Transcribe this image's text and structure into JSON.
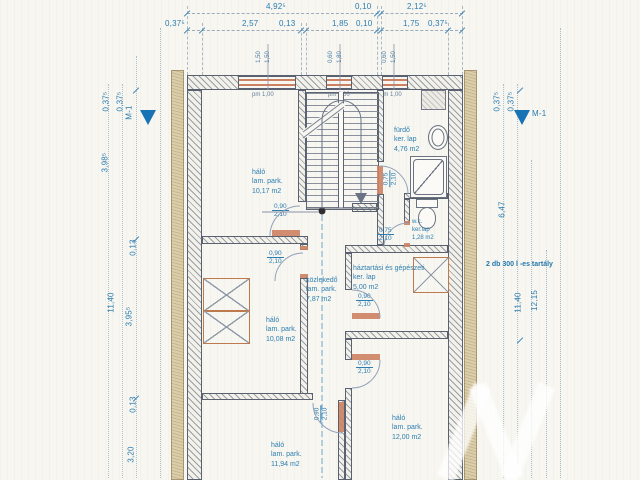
{
  "dims": {
    "top_row1": [
      "4,92⁵",
      "0,10",
      "2,12⁵"
    ],
    "top_row2": [
      "0,37⁵",
      "2,57",
      "0,13",
      "1,85",
      "0,10",
      "1,75",
      "0,37⁵"
    ],
    "left": [
      "0,37⁵",
      "0,37⁵",
      "3,98⁵",
      "0,13",
      "11,40",
      "3,95⁵",
      "0,13",
      "3,20"
    ],
    "right": [
      "0,37⁵",
      "0,37⁵",
      "6,47",
      "11,40",
      "12,15"
    ]
  },
  "markers": {
    "left": "M-1",
    "right": "M-1"
  },
  "windows": [
    {
      "w": "1,50",
      "h": "1,50",
      "sill": "pm 1,00"
    },
    {
      "w": "0,60",
      "h": "1,80",
      "sill": "pm 0,00"
    },
    {
      "w": "0,60",
      "h": "1,50",
      "sill": "pm 1,00"
    }
  ],
  "rooms": {
    "bed1": {
      "name": "háló",
      "finish": "lam. park.",
      "area": "10,17 m2"
    },
    "bath": {
      "name": "fürdő",
      "finish": "ker. lap",
      "area": "4,76 m2"
    },
    "wc": {
      "name": "w.c.",
      "finish": "ker.lap",
      "area": "1,28 m2"
    },
    "utility": {
      "name": "háztartási és gépészeti",
      "finish": "ker. lap",
      "area": "5,00 m2"
    },
    "hall": {
      "name": "közlekedő",
      "finish": "lam. park.",
      "area": "7,87 m2"
    },
    "bed2": {
      "name": "háló",
      "finish": "lam. park.",
      "area": "10,08 m2"
    },
    "bed3": {
      "name": "háló",
      "finish": "lam. park.",
      "area": "11,94 m2"
    },
    "bed4": {
      "name": "háló",
      "finish": "lam. park.",
      "area": "12,00 m2"
    }
  },
  "doors": {
    "bed1": {
      "w": "0,90",
      "h": "2,10"
    },
    "bed2": {
      "w": "0,90",
      "h": "2,10"
    },
    "bath": {
      "w": "0,75",
      "h": "2,10"
    },
    "wc": {
      "w": "0,75",
      "h": "2,10"
    },
    "utility": {
      "w": "0,90",
      "h": "2,10"
    },
    "bed4": {
      "w": "0,90",
      "h": "2,10"
    },
    "bed3": {
      "w": "0,90",
      "h": "2,10"
    }
  },
  "notes": {
    "tank": "2 db 300 l -es tartály"
  },
  "colors": {
    "dim_text": "#2b7cb0",
    "wall_line": "#596070",
    "accent_orange": "#cd8160",
    "insulation": "#dbcfab",
    "marker_blue": "#1873b5"
  }
}
